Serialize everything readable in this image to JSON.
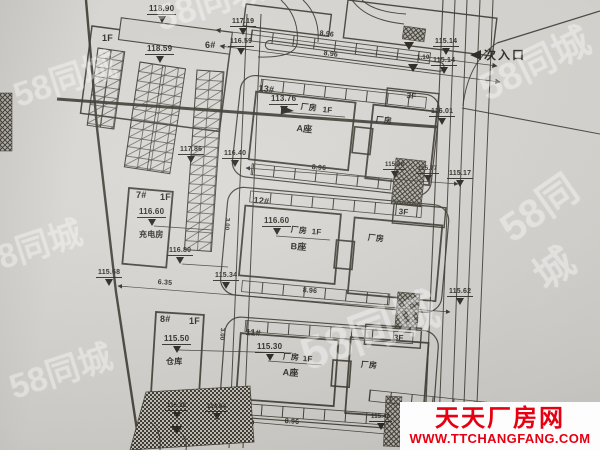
{
  "colors": {
    "banner_red": "#e60012",
    "ink": "#34312a",
    "paper": "#d8d6d2",
    "watermark": "#ffffff"
  },
  "watermark": {
    "text": "58同城",
    "positions": [
      {
        "x": 148,
        "y": -8,
        "s": 36,
        "r": -18
      },
      {
        "x": 6,
        "y": 70,
        "s": 34,
        "r": -18
      },
      {
        "x": -28,
        "y": 238,
        "s": 34,
        "r": -18
      },
      {
        "x": 2,
        "y": 362,
        "s": 34,
        "r": -18
      },
      {
        "x": 290,
        "y": 322,
        "s": 46,
        "r": -20
      },
      {
        "x": 468,
        "y": 62,
        "s": 38,
        "r": -26
      },
      {
        "x": 486,
        "y": 206,
        "s": 40,
        "r": -35
      }
    ]
  },
  "banner": {
    "title": "天天厂房网",
    "url": "WWW.TTCHANGFANG.COM"
  },
  "plan": {
    "entrance": {
      "label": "次入口"
    },
    "labels": [
      {
        "t": "118.90",
        "x": 147,
        "y": 5,
        "s": 8,
        "k": "elev"
      },
      {
        "t": "1F",
        "x": 102,
        "y": 34,
        "s": 9,
        "k": "txt",
        "n": "floor-label-6"
      },
      {
        "t": "6#",
        "x": 205,
        "y": 41,
        "s": 9,
        "k": "txt",
        "n": "building-id-6"
      },
      {
        "t": "118.59",
        "x": 145,
        "y": 45,
        "s": 8,
        "k": "elev"
      },
      {
        "t": "117.19",
        "x": 230,
        "y": 18,
        "s": 7,
        "k": "elev"
      },
      {
        "t": "116.59",
        "x": 228,
        "y": 38,
        "s": 7,
        "k": "elev"
      },
      {
        "t": "8.96",
        "x": 320,
        "y": 30,
        "s": 7,
        "r": 7,
        "k": "dim"
      },
      {
        "t": "8.96",
        "x": 324,
        "y": 50,
        "s": 7,
        "r": 7,
        "k": "dim"
      },
      {
        "t": "115.14",
        "x": 433,
        "y": 38,
        "s": 7,
        "k": "elev"
      },
      {
        "t": "115.14",
        "x": 431,
        "y": 57,
        "s": 7,
        "k": "elev"
      },
      {
        "t": "1.10",
        "x": 417,
        "y": 55,
        "s": 6,
        "k": "dim"
      },
      {
        "t": "116.01",
        "x": 429,
        "y": 108,
        "s": 7,
        "k": "elev"
      },
      {
        "t": "13#",
        "x": 259,
        "y": 84,
        "s": 9,
        "r": 6,
        "k": "txt",
        "n": "building-id-13"
      },
      {
        "t": "113.76",
        "x": 269,
        "y": 95,
        "s": 8,
        "k": "elev"
      },
      {
        "t": "厂房",
        "x": 301,
        "y": 103,
        "s": 8,
        "r": 6,
        "k": "txt",
        "n": "building-use-13"
      },
      {
        "t": "1F",
        "x": 323,
        "y": 106,
        "s": 8,
        "r": 6,
        "k": "txt"
      },
      {
        "t": "A座",
        "x": 297,
        "y": 124,
        "s": 9,
        "r": 6,
        "k": "txt",
        "n": "building-wing-13"
      },
      {
        "t": "3F",
        "x": 407,
        "y": 92,
        "s": 8,
        "r": 6,
        "k": "txt"
      },
      {
        "t": "厂房",
        "x": 376,
        "y": 116,
        "s": 8,
        "r": 6,
        "k": "txt"
      },
      {
        "t": "117.86",
        "x": 178,
        "y": 146,
        "s": 7,
        "k": "elev"
      },
      {
        "t": "116.40",
        "x": 222,
        "y": 150,
        "s": 7,
        "k": "elev"
      },
      {
        "t": "8.96",
        "x": 312,
        "y": 164,
        "s": 7,
        "r": 5,
        "k": "dim"
      },
      {
        "t": "115.68",
        "x": 383,
        "y": 162,
        "s": 6,
        "k": "elev"
      },
      {
        "t": "115.77",
        "x": 416,
        "y": 166,
        "s": 6,
        "k": "elev"
      },
      {
        "t": "115.17",
        "x": 447,
        "y": 170,
        "s": 7,
        "k": "elev"
      },
      {
        "t": "12#",
        "x": 254,
        "y": 196,
        "s": 9,
        "r": 5,
        "k": "txt",
        "n": "building-id-12"
      },
      {
        "t": "116.60",
        "x": 262,
        "y": 217,
        "s": 8,
        "k": "elev"
      },
      {
        "t": "厂房",
        "x": 291,
        "y": 226,
        "s": 8,
        "r": 5,
        "k": "txt",
        "n": "building-use-12"
      },
      {
        "t": "1F",
        "x": 312,
        "y": 228,
        "s": 8,
        "r": 5,
        "k": "txt"
      },
      {
        "t": "B座",
        "x": 291,
        "y": 242,
        "s": 9,
        "r": 5,
        "k": "txt",
        "n": "building-wing-12"
      },
      {
        "t": "厂房",
        "x": 368,
        "y": 234,
        "s": 8,
        "r": 5,
        "k": "txt"
      },
      {
        "t": "3F",
        "x": 399,
        "y": 208,
        "s": 8,
        "r": 5,
        "k": "txt"
      },
      {
        "t": "3.00",
        "x": 230,
        "y": 218,
        "s": 6,
        "r": 94,
        "k": "dim"
      },
      {
        "t": "7#",
        "x": 136,
        "y": 191,
        "s": 9,
        "k": "txt",
        "n": "building-id-7"
      },
      {
        "t": "1F",
        "x": 160,
        "y": 193,
        "s": 9,
        "k": "txt"
      },
      {
        "t": "116.60",
        "x": 137,
        "y": 208,
        "s": 8,
        "k": "elev"
      },
      {
        "t": "充电房",
        "x": 139,
        "y": 231,
        "s": 8,
        "k": "txt",
        "n": "building-name-charging-room"
      },
      {
        "t": "116.80",
        "x": 167,
        "y": 247,
        "s": 7,
        "k": "elev"
      },
      {
        "t": "115.68",
        "x": 96,
        "y": 269,
        "s": 7,
        "k": "elev"
      },
      {
        "t": "6.35",
        "x": 158,
        "y": 279,
        "s": 7,
        "r": 4,
        "k": "dim"
      },
      {
        "t": "115.34",
        "x": 213,
        "y": 272,
        "s": 7,
        "k": "elev"
      },
      {
        "t": "8.96",
        "x": 303,
        "y": 287,
        "s": 7,
        "r": 5,
        "k": "dim"
      },
      {
        "t": "115.62",
        "x": 447,
        "y": 288,
        "s": 7,
        "k": "elev"
      },
      {
        "t": "3.00",
        "x": 225,
        "y": 328,
        "s": 6,
        "r": 94,
        "k": "dim"
      },
      {
        "t": "8#",
        "x": 160,
        "y": 315,
        "s": 9,
        "k": "txt",
        "n": "building-id-8"
      },
      {
        "t": "1F",
        "x": 189,
        "y": 317,
        "s": 9,
        "k": "txt"
      },
      {
        "t": "115.50",
        "x": 162,
        "y": 335,
        "s": 8,
        "k": "elev"
      },
      {
        "t": "仓库",
        "x": 166,
        "y": 358,
        "s": 8,
        "k": "txt",
        "n": "building-name-warehouse"
      },
      {
        "t": "11#",
        "x": 246,
        "y": 328,
        "s": 9,
        "r": 4,
        "k": "txt",
        "n": "building-id-11"
      },
      {
        "t": "115.30",
        "x": 255,
        "y": 343,
        "s": 8,
        "k": "elev"
      },
      {
        "t": "厂房",
        "x": 283,
        "y": 353,
        "s": 8,
        "r": 4,
        "k": "txt",
        "n": "building-use-11"
      },
      {
        "t": "1F",
        "x": 303,
        "y": 355,
        "s": 8,
        "r": 4,
        "k": "txt"
      },
      {
        "t": "A座",
        "x": 283,
        "y": 368,
        "s": 9,
        "r": 4,
        "k": "txt",
        "n": "building-wing-11"
      },
      {
        "t": "厂房",
        "x": 361,
        "y": 361,
        "s": 8,
        "r": 4,
        "k": "txt"
      },
      {
        "t": "3F",
        "x": 394,
        "y": 334,
        "s": 8,
        "r": 4,
        "k": "txt"
      },
      {
        "t": "115.38",
        "x": 165,
        "y": 403,
        "s": 6,
        "k": "elev"
      },
      {
        "t": "114.94",
        "x": 205,
        "y": 404,
        "s": 6,
        "k": "elev"
      },
      {
        "t": "8.96",
        "x": 285,
        "y": 418,
        "s": 7,
        "r": 4,
        "k": "dim"
      },
      {
        "t": "115.48",
        "x": 369,
        "y": 414,
        "s": 6,
        "k": "elev"
      }
    ]
  }
}
